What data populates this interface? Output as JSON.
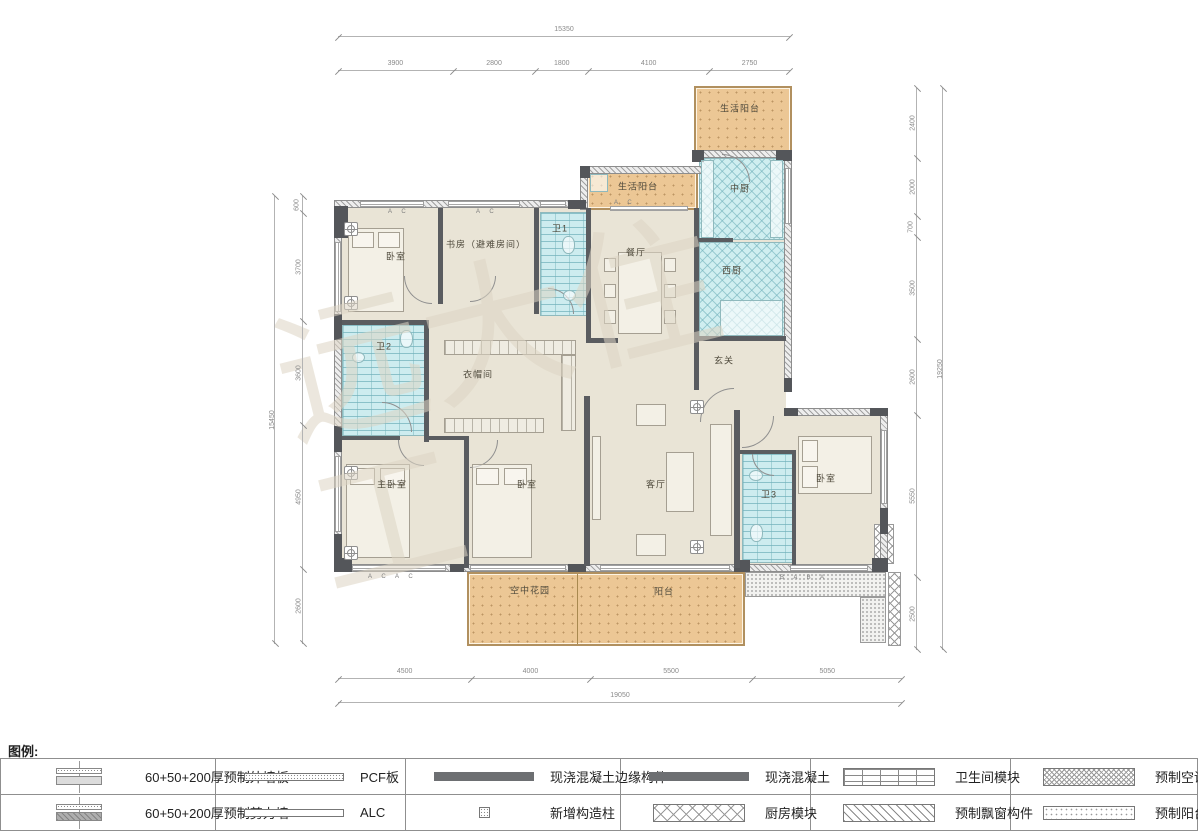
{
  "watermark": "远大住工",
  "rooms": {
    "balcony_top": "生活阳台",
    "balcony_strip": "生活阳台",
    "kitchen_cn": "中厨",
    "kitchen_w": "西厨",
    "dining": "餐厅",
    "foyer": "玄关",
    "living": "客厅",
    "bath1": "卫1",
    "bath2": "卫2",
    "bath3": "卫3",
    "study": "书房（避难房间）",
    "bedroom_tl": "卧室",
    "master": "主卧室",
    "bedroom_mid": "卧室",
    "bedroom_r": "卧室",
    "closet": "衣帽间",
    "sky_garden": "空中花园",
    "balcony_main": "阳台"
  },
  "dimensions": {
    "top": {
      "total": "15350",
      "segments": [
        "3900",
        "2800",
        "1800",
        "4100",
        "2750"
      ]
    },
    "bottom": {
      "total": "19050",
      "segments": [
        "4500",
        "4000",
        "5500",
        "5050"
      ]
    },
    "left": {
      "total": "15450",
      "segments": [
        "600",
        "3700",
        "3600",
        "4950",
        "2600"
      ]
    },
    "right": {
      "total": "19250",
      "segments": [
        "2400",
        "2000",
        "700",
        "3500",
        "2600",
        "5550",
        "2500"
      ]
    }
  },
  "panel_codes": {
    "c1": "A C",
    "c2": "A C",
    "c3": "A C",
    "c4": "A C A C",
    "c5": "B A B A"
  },
  "legend": {
    "title": "图例:",
    "rows": [
      [
        {
          "icon": "exterior-wall-panel-icon",
          "label": "60+50+200厚预制外墙板"
        },
        {
          "icon": "pcf-board-icon",
          "label": "PCF板"
        },
        {
          "icon": "cast-in-place-edge-icon",
          "label": "现浇混凝土边缘构件"
        },
        {
          "icon": "cast-in-place-icon",
          "label": "现浇混凝土"
        },
        {
          "icon": "bathroom-module-icon",
          "label": "卫生间模块"
        },
        {
          "icon": "ac-panel-icon",
          "label": "预制空调板构件"
        }
      ],
      [
        {
          "icon": "shear-wall-panel-icon",
          "label": "60+50+200厚预制剪力墙"
        },
        {
          "icon": "alc-board-icon",
          "label": "ALC"
        },
        {
          "icon": "new-column-icon",
          "label": "新增构造柱"
        },
        {
          "icon": "kitchen-module-icon",
          "label": "厨房模块"
        },
        {
          "icon": "bay-window-icon",
          "label": "预制飘窗构件"
        },
        {
          "icon": "balcony-member-icon",
          "label": "预制阳台构件"
        }
      ]
    ]
  },
  "colors": {
    "room_fill": "#e9e4d6",
    "balcony_fill": "#ecc795",
    "module_fill": "#cfeef0",
    "wall_dark": "#54565a"
  }
}
